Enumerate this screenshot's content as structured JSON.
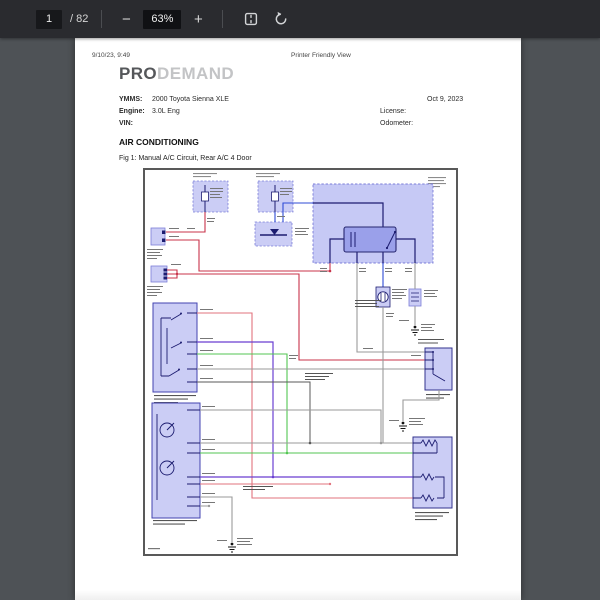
{
  "toolbar": {
    "page_current": "1",
    "page_count": "/ 82",
    "zoom_out": "−",
    "zoom_level": "63%",
    "zoom_in": "+"
  },
  "document": {
    "timestamp": "9/10/23, 9:49",
    "header_center": "Printer Friendly View",
    "logo": {
      "bold": "PRO",
      "light": "DEMAND"
    },
    "info": {
      "ymms_label": "YMMS:",
      "ymms_value": "2000 Toyota Sienna XLE",
      "engine_label": "Engine:",
      "engine_value": "3.0L Eng",
      "vin_label": "VIN:",
      "date": "Oct 9, 2023",
      "license_label": "License:",
      "odometer_label": "Odometer:"
    },
    "section_title": "AIR CONDITIONING",
    "figure_caption": "Fig 1: Manual A/C Circuit, Rear A/C 4 Door"
  },
  "diagram": {
    "palette": {
      "component_fill": "#cbcdf5",
      "component_dashed_border": "#7b7dd8",
      "component_solid_border": "#4343b0",
      "relay_fill": "#9aa0ea",
      "wire_navy": "#1c1c70",
      "wire_blue": "#2f4bd6",
      "wire_red": "#c8334a",
      "wire_pink": "#e2737e",
      "wire_green": "#53c653",
      "wire_purple": "#6a3fd1",
      "wire_gray": "#9a9a9a",
      "wire_dark": "#5a5a5a"
    }
  }
}
